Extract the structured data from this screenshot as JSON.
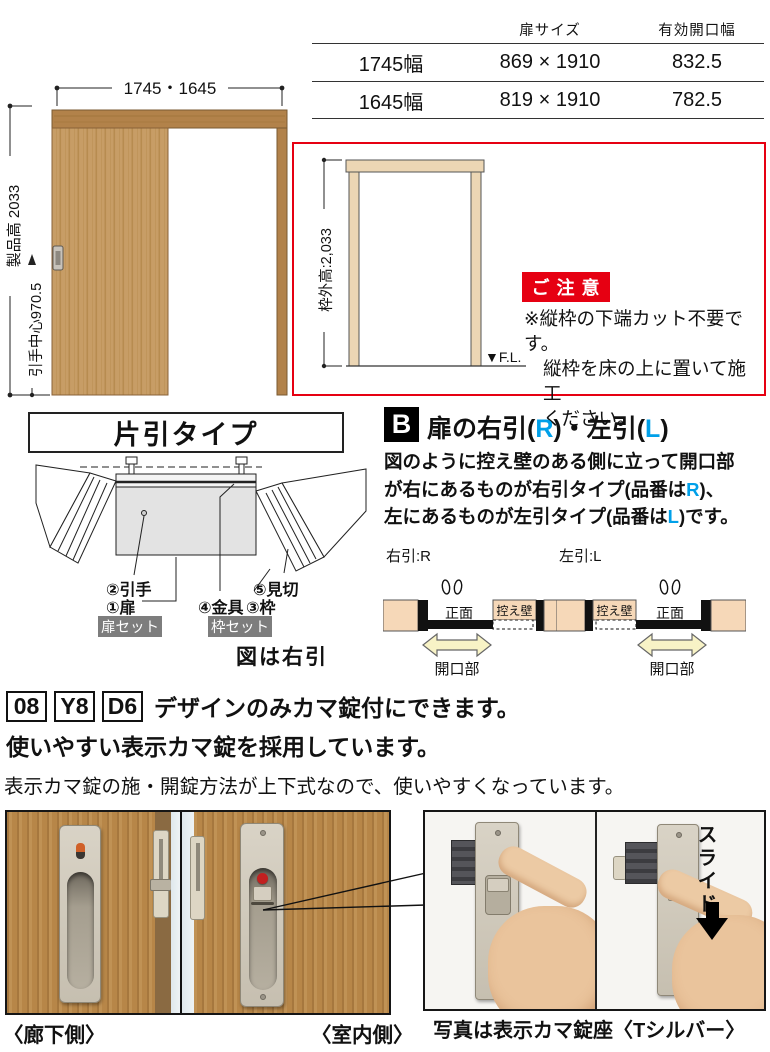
{
  "colors": {
    "red": "#e60012",
    "blue": "#00a0e9",
    "wall_peach": "#f6d8b8",
    "arrow_yellow": "#f8f3c6",
    "badge_gray": "#7d7d7d"
  },
  "size_table": {
    "col_headers": [
      "扉サイズ",
      "有効開口幅"
    ],
    "rows": [
      {
        "name": "1745幅",
        "door_size": "869 × 1910",
        "opening": "832.5"
      },
      {
        "name": "1645幅",
        "door_size": "819 × 1910",
        "opening": "782.5"
      }
    ]
  },
  "elevation": {
    "width_dim": "1745・1645",
    "height_dim": "製品高 2033",
    "handle_dim": "引手中心970.5"
  },
  "notice": {
    "frame_dim": "枠外高:2,033",
    "fl": "▼F.L.",
    "badge": "ご注意",
    "line1": "※縦枠の下端カット不要です。",
    "line2": "縦枠を床の上に置いて施工",
    "line3": "ください。"
  },
  "katabiki": {
    "title": "片引タイプ",
    "label_hikite": "②引手",
    "label_tobira": "①扉",
    "label_kanagu": "④金具",
    "label_mikiri": "⑤見切",
    "label_waku": "③枠",
    "badge_tobira_set": "扉セット",
    "badge_waku_set": "枠セット",
    "caption": "図は右引"
  },
  "section_b": {
    "badge": "B",
    "title_pre": "扉の右引(",
    "title_r": "R",
    "title_mid": ")・左引(",
    "title_l": "L",
    "title_post": ")",
    "line1": "図のように控え壁のある側に立って開口部",
    "line2_pre": "が右にあるものが右引タイプ(品番は",
    "line2_r": "R",
    "line2_post": ")、",
    "line3_pre": "左にあるものが左引タイプ(品番は",
    "line3_l": "L",
    "line3_post": ")です。",
    "diagram_r": {
      "title": "右引:R",
      "front": "正面",
      "pocket": "控え壁",
      "opening": "開口部"
    },
    "diagram_l": {
      "title": "左引:L",
      "front": "正面",
      "pocket": "控え壁",
      "opening": "開口部"
    }
  },
  "lock_feature": {
    "code1": "08",
    "code2": "Y8",
    "code3": "D6",
    "headline1": "デザインのみカマ錠付にできます。",
    "headline2": "使いやすい表示カマ錠を採用しています。",
    "body": "表示カマ錠の施・開錠方法が上下式なので、使いやすくなっています。"
  },
  "photos": {
    "corridor_caption": "〈廊下側〉",
    "room_caption": "〈室内側〉",
    "slide_label": "スライド",
    "caption": "写真は表示カマ錠座〈Tシルバー〉"
  }
}
